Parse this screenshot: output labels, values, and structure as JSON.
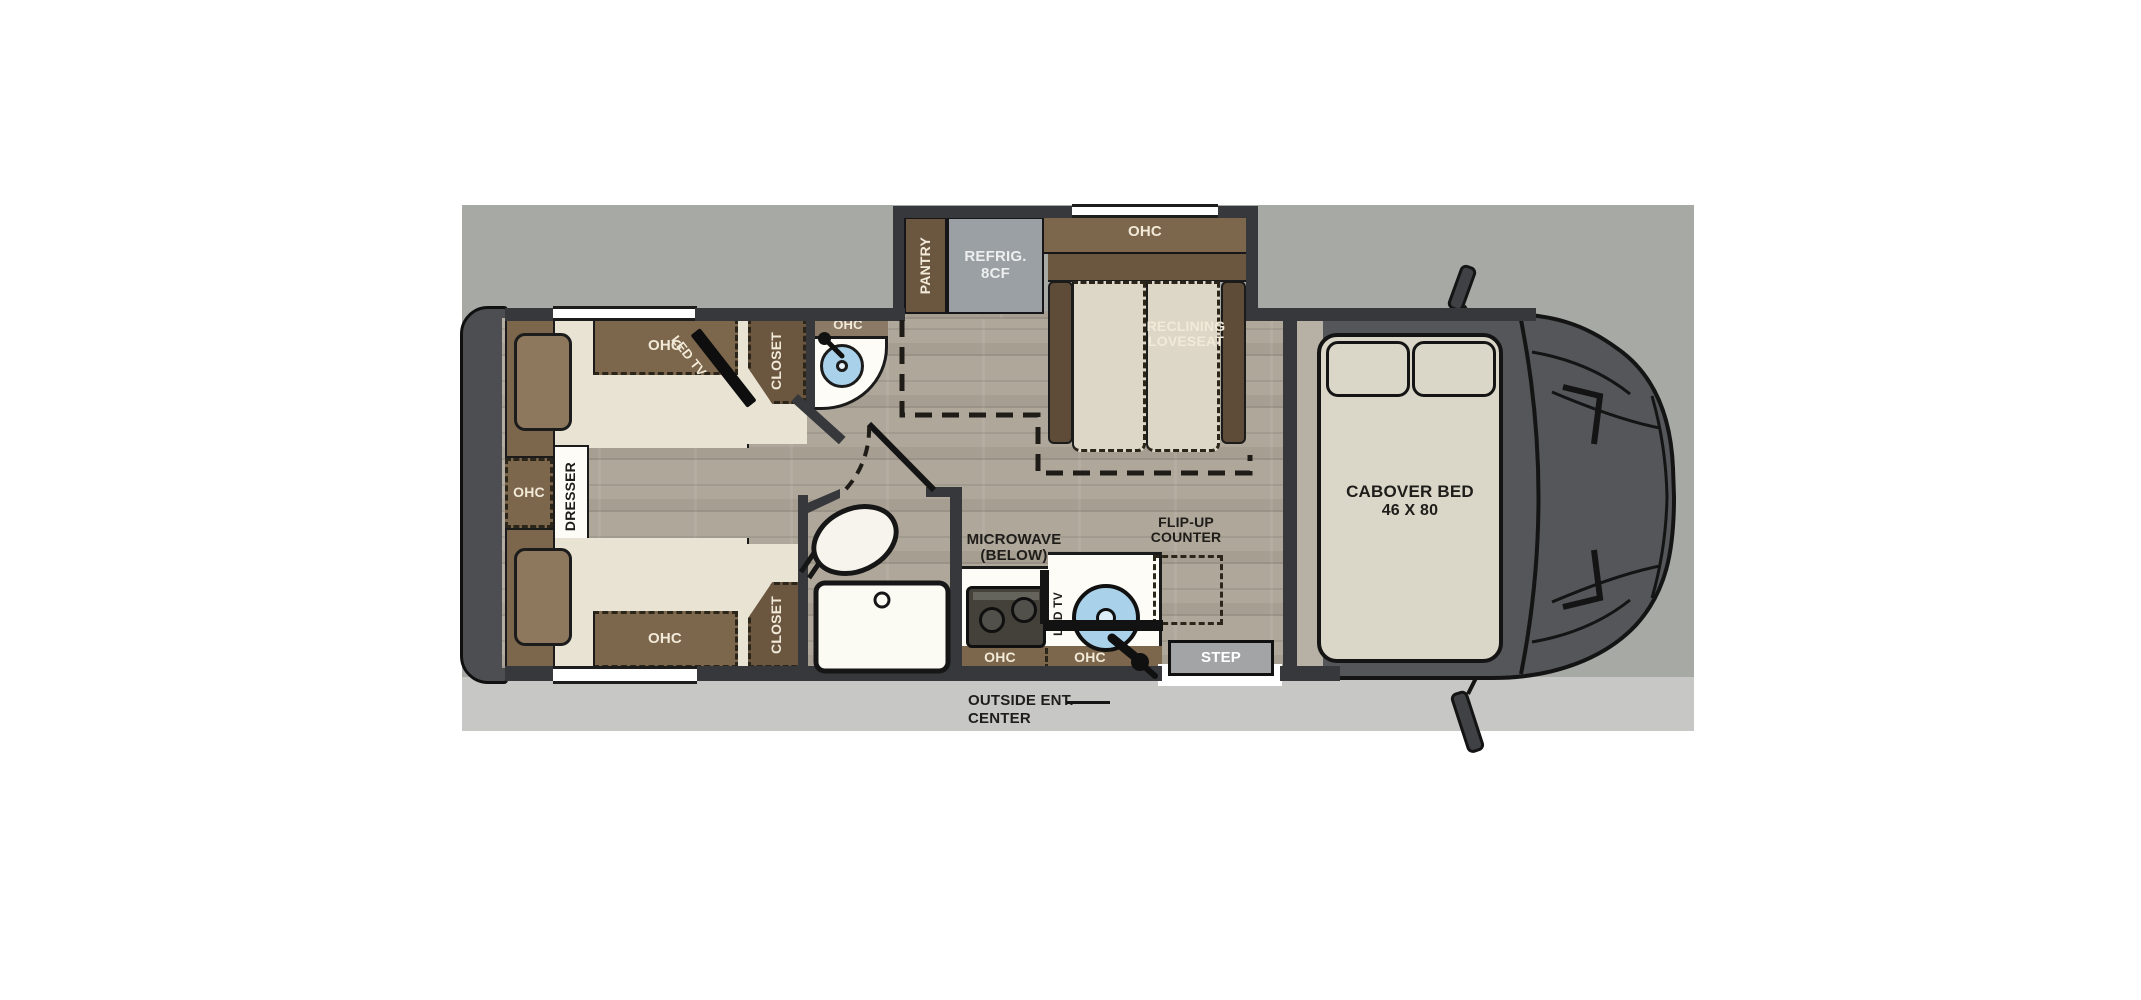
{
  "labels": {
    "pantry": "PANTRY",
    "refrig1": "REFRIG.",
    "refrig2": "8CF",
    "ohc": "OHC",
    "reclining1": "RECLINING",
    "reclining2": "LOVESEAT",
    "led_tv": "LED TV",
    "closet": "CLOSET",
    "dresser": "DRESSER",
    "microwave1": "MICROWAVE",
    "microwave2": "(BELOW)",
    "flipup1": "FLIP-UP",
    "flipup2": "COUNTER",
    "step": "STEP",
    "outside1": "OUTSIDE ENT.",
    "outside2": "CENTER",
    "cabover1": "CABOVER BED",
    "cabover2": "46 X 80"
  },
  "colors": {
    "backdrop": "#a7a9a5",
    "backdrop_light": "#c7c8c5",
    "wall": "#36383b",
    "cab_body": "#54565a",
    "cabinet_brown": "#7c664c",
    "cabinet_brown_dark": "#6b5640",
    "armrest_brown": "#5f4c38",
    "mattress_beige": "#e9e3d4",
    "cushion_beige": "#dcd7c7",
    "bed_beige": "#dad6c8",
    "wood_floor": "#afa79a",
    "refrigerator_grey": "#9aa0a3",
    "counter_white": "#fdfcf6",
    "sink_blue": "#a9d2ea",
    "step_grey": "#a2a4a6",
    "pillow_brown": "#8d785e",
    "label_cream": "#f2ead9",
    "label_black": "#1f1d1a"
  }
}
